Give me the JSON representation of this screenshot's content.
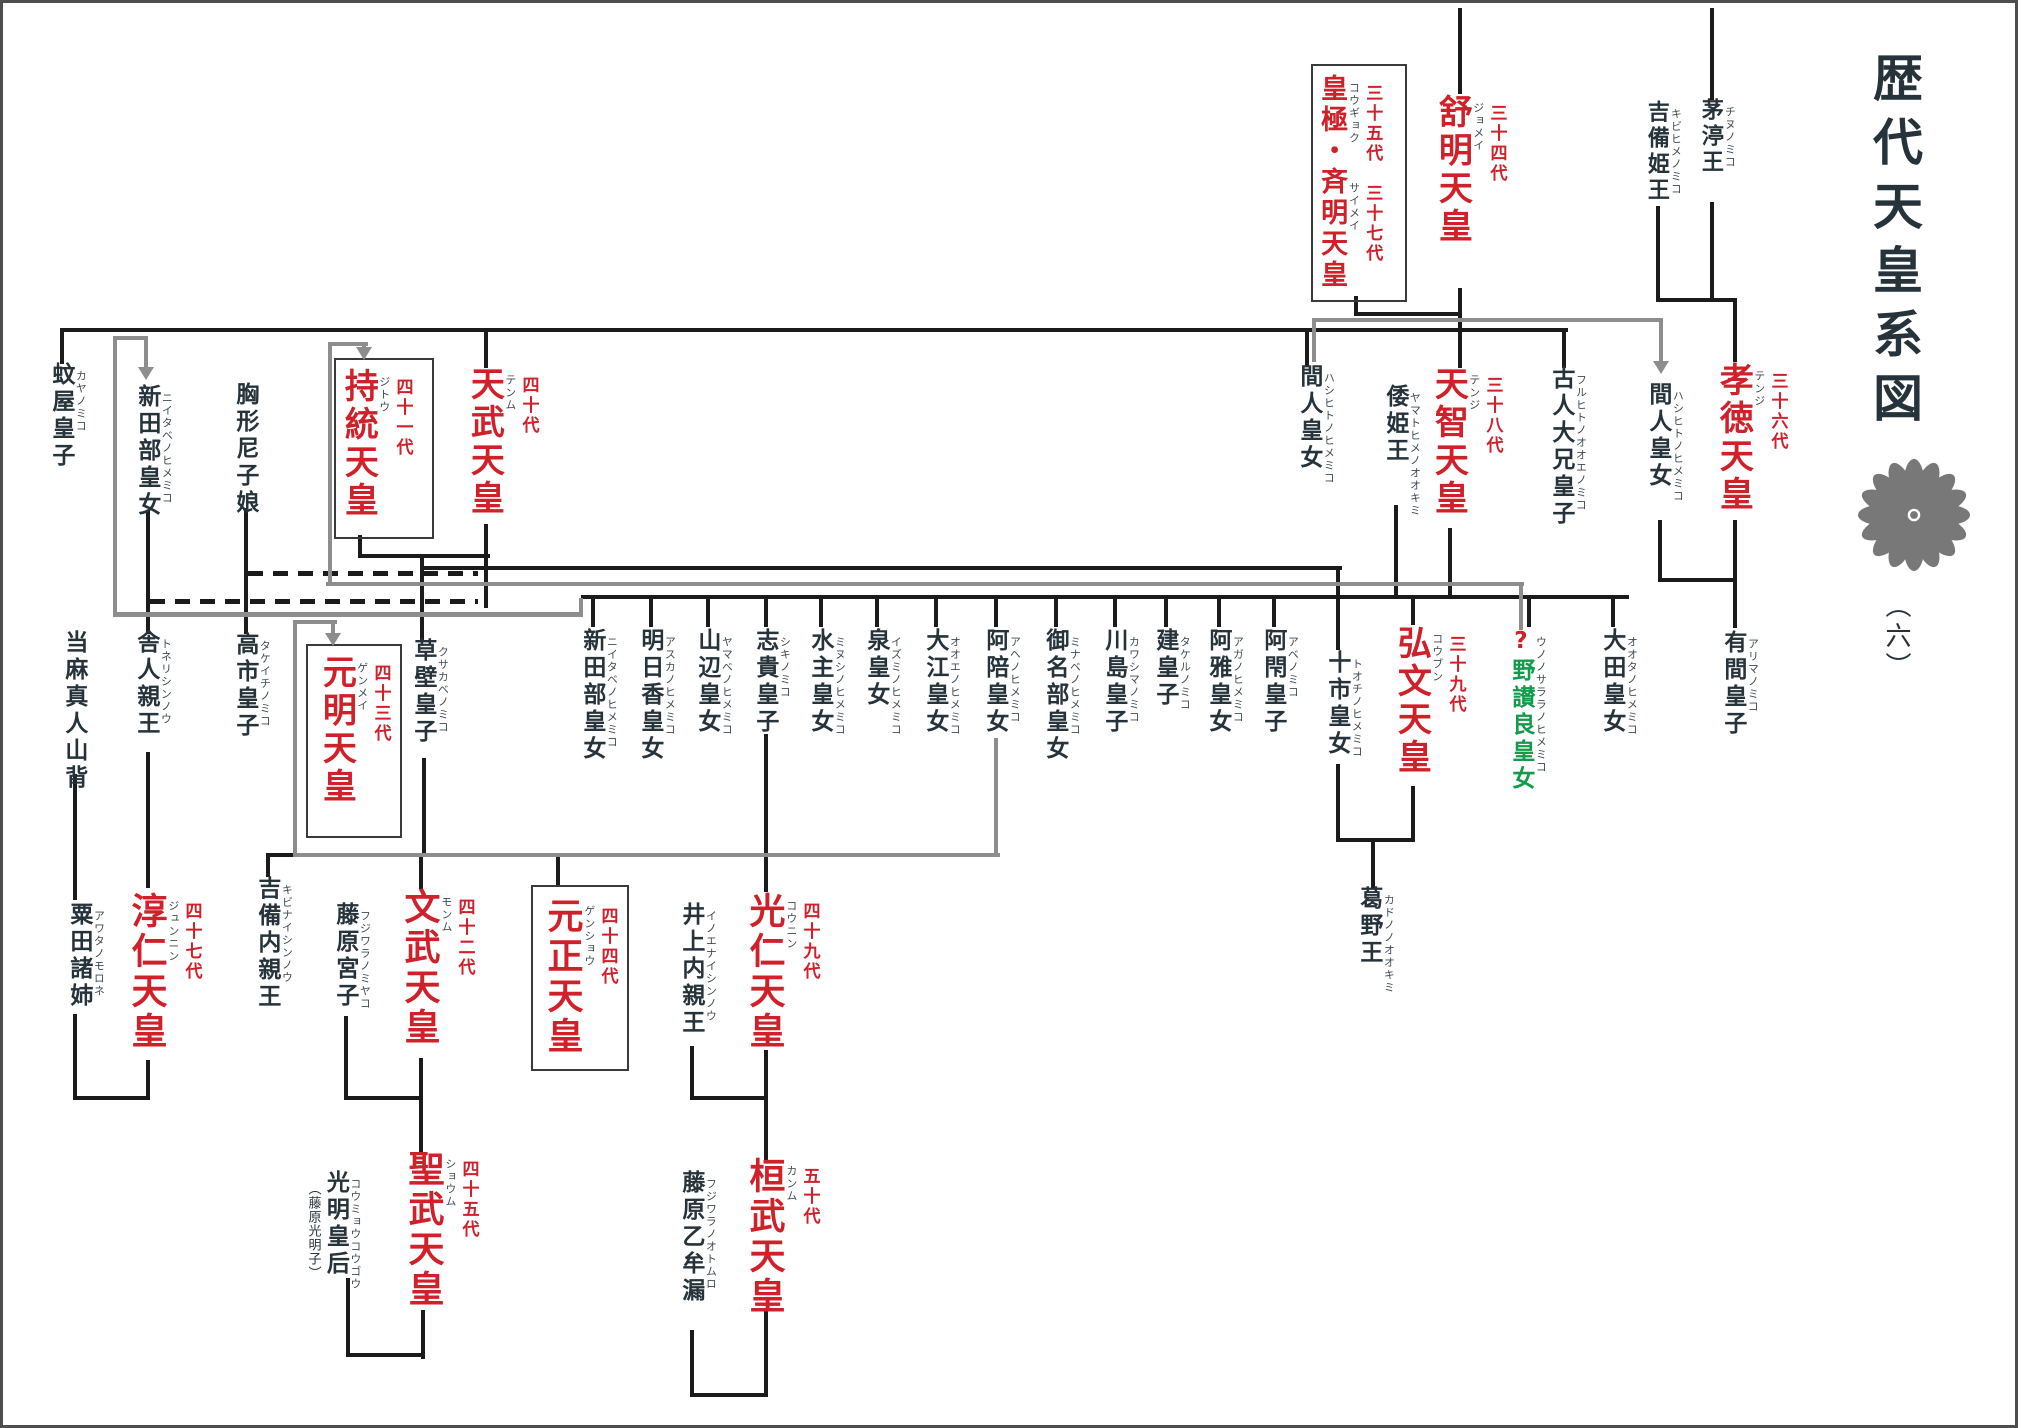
{
  "title": {
    "text": "歴代天皇系図",
    "part": "（六）"
  },
  "colors": {
    "emperor_red": "#d0202a",
    "person_black": "#26333b",
    "reading_gray": "#3c4a52",
    "special_green": "#139a4a",
    "line_black": "#1b1b1b",
    "line_gray": "#8d8d8d",
    "seal_gray": "#787878",
    "background": "#ffffff"
  },
  "nodes": [
    {
      "id": "chinu",
      "name": "茅渟王",
      "reading": "チヌノミコ",
      "x": 1698,
      "y": 98,
      "s": 22
    },
    {
      "id": "kibihime",
      "name": "吉備姫王",
      "reading": "キビヒメノミコ",
      "x": 1644,
      "y": 100,
      "s": 22
    },
    {
      "id": "kotoku",
      "name": "孝徳天皇",
      "reading": "テンジ",
      "gen": "三十六代",
      "x": 1715,
      "y": 362,
      "s": 34,
      "c": "red"
    },
    {
      "id": "hashihito-r",
      "name": "間人皇女",
      "reading": "ハシヒトノヒメミコ",
      "x": 1645,
      "y": 382,
      "s": 23
    },
    {
      "id": "arima",
      "name": "有間皇子",
      "reading": "アリマノミコ",
      "x": 1720,
      "y": 630,
      "s": 23
    },
    {
      "id": "jomei",
      "name": "舒明天皇",
      "reading": "ジョメイ",
      "gen": "三十四代",
      "x": 1434,
      "y": 94,
      "s": 34,
      "c": "red"
    },
    {
      "id": "kogyoku-saimei",
      "name": "皇極・斉明天皇",
      "reading": "コウギョク　　　サイメイ",
      "gen": "三十五代　三十七代",
      "x": 1317,
      "y": 74,
      "s": 27,
      "c": "red",
      "box": {
        "x": 1311,
        "y": 64,
        "w": 92,
        "h": 234
      }
    },
    {
      "id": "furuhito",
      "name": "古人大兄皇子",
      "reading": "フルヒトノオオエノミコ",
      "x": 1548,
      "y": 366,
      "s": 23
    },
    {
      "id": "tenji",
      "name": "天智天皇",
      "reading": "テンジ",
      "gen": "三十八代",
      "x": 1430,
      "y": 366,
      "s": 34,
      "c": "red"
    },
    {
      "id": "yamatohime",
      "name": "倭姫王",
      "reading": "ヤマトヒメノオオキミ",
      "x": 1382,
      "y": 384,
      "s": 23
    },
    {
      "id": "hashihito-l",
      "name": "間人皇女",
      "reading": "ハシヒトノヒメミコ",
      "x": 1296,
      "y": 364,
      "s": 23
    },
    {
      "id": "kaya",
      "name": "蚊屋皇子",
      "reading": "カヤノミコ",
      "x": 48,
      "y": 362,
      "s": 23
    },
    {
      "id": "niitabe-1",
      "name": "新田部皇女",
      "reading": "ニイタベノヒメミコ",
      "x": 134,
      "y": 384,
      "s": 23
    },
    {
      "id": "munakata",
      "name": "胸形尼子娘",
      "x": 232,
      "y": 382,
      "s": 23
    },
    {
      "id": "jito",
      "name": "持統天皇",
      "reading": "ジトウ",
      "gen": "四十一代",
      "x": 340,
      "y": 368,
      "s": 34,
      "c": "red",
      "box": {
        "x": 334,
        "y": 358,
        "w": 96,
        "h": 177
      }
    },
    {
      "id": "temmu",
      "name": "天武天皇",
      "reading": "テンム",
      "gen": "四十代",
      "x": 466,
      "y": 366,
      "s": 34,
      "c": "red"
    },
    {
      "id": "niitabe-2",
      "name": "新田部皇女",
      "reading": "ニイタベノヒメミコ",
      "x": 579,
      "y": 628,
      "s": 23
    },
    {
      "id": "asuka",
      "name": "明日香皇女",
      "reading": "アスカノヒメミコ",
      "x": 637,
      "y": 628,
      "s": 23
    },
    {
      "id": "yamabe",
      "name": "山辺皇女",
      "reading": "ヤマベノヒメミコ",
      "x": 694,
      "y": 628,
      "s": 23
    },
    {
      "id": "shiki",
      "name": "志貴皇子",
      "reading": "シキノミコ",
      "x": 752,
      "y": 628,
      "s": 23
    },
    {
      "id": "minushi",
      "name": "水主皇女",
      "reading": "ミヌシノヒメミコ",
      "x": 807,
      "y": 628,
      "s": 23
    },
    {
      "id": "izumi",
      "name": "泉皇女",
      "reading": "イズミノヒメミコ",
      "x": 863,
      "y": 628,
      "s": 23
    },
    {
      "id": "ooe",
      "name": "大江皇女",
      "reading": "オオエノヒメミコ",
      "x": 922,
      "y": 628,
      "s": 23
    },
    {
      "id": "ahe",
      "name": "阿陪皇女",
      "reading": "アヘノヒメミコ",
      "x": 982,
      "y": 628,
      "s": 23
    },
    {
      "id": "minabe",
      "name": "御名部皇女",
      "reading": "ミナベノヒメミコ",
      "x": 1042,
      "y": 628,
      "s": 23
    },
    {
      "id": "kawashima",
      "name": "川島皇子",
      "reading": "カワシマノミコ",
      "x": 1101,
      "y": 628,
      "s": 23
    },
    {
      "id": "takeru",
      "name": "建皇子",
      "reading": "タケルノミコ",
      "x": 1152,
      "y": 628,
      "s": 23
    },
    {
      "id": "aga",
      "name": "阿雅皇女",
      "reading": "アガノヒメミコ",
      "x": 1205,
      "y": 628,
      "s": 23
    },
    {
      "id": "abe",
      "name": "阿閇皇子",
      "reading": "アベノミコ",
      "x": 1260,
      "y": 628,
      "s": 23
    },
    {
      "id": "tochi",
      "name": "十市皇女",
      "reading": "トオチノヒメミコ",
      "x": 1324,
      "y": 650,
      "s": 23
    },
    {
      "id": "kobun",
      "name": "弘文天皇",
      "reading": "コウブン",
      "gen": "三十九代",
      "x": 1393,
      "y": 625,
      "s": 34,
      "c": "red"
    },
    {
      "id": "uno-no-sarara",
      "parts": [
        {
          "t": "?",
          "c": "#d0202a"
        },
        {
          "t": "野讃良皇女",
          "c": "#139a4a"
        }
      ],
      "reading": "ウノノサララノヒメミコ",
      "x": 1508,
      "y": 628,
      "s": 23
    },
    {
      "id": "oota",
      "name": "大田皇女",
      "reading": "オオタノヒメミコ",
      "x": 1599,
      "y": 628,
      "s": 23
    },
    {
      "id": "taima",
      "name": "当麻真人山背",
      "x": 61,
      "y": 630,
      "s": 23
    },
    {
      "id": "toneri",
      "name": "舎人親王",
      "reading": "トネリシンノウ",
      "x": 133,
      "y": 630,
      "s": 23
    },
    {
      "id": "takechi",
      "name": "高市皇子",
      "reading": "タケイチノミコ",
      "x": 232,
      "y": 632,
      "s": 23
    },
    {
      "id": "gemmei",
      "name": "元明天皇",
      "reading": "ゲンメイ",
      "gen": "四十三代",
      "x": 318,
      "y": 654,
      "s": 34,
      "c": "red",
      "box": {
        "x": 306,
        "y": 644,
        "w": 92,
        "h": 190
      }
    },
    {
      "id": "kusakabe",
      "name": "草壁皇子",
      "reading": "クサカベノミコ",
      "x": 410,
      "y": 638,
      "s": 23
    },
    {
      "id": "kadono",
      "name": "葛野王",
      "reading": "カドノノオオキミ",
      "x": 1356,
      "y": 886,
      "s": 23
    },
    {
      "id": "awata",
      "name": "粟田諸姉",
      "reading": "アワタノモロネ",
      "x": 66,
      "y": 902,
      "s": 23
    },
    {
      "id": "junnin",
      "name": "淳仁天皇",
      "reading": "ジュンニン",
      "gen": "四十七代",
      "x": 127,
      "y": 892,
      "s": 36,
      "c": "red"
    },
    {
      "id": "kibi-naishinno",
      "name": "吉備内親王",
      "reading": "キビナイシンノウ",
      "x": 254,
      "y": 876,
      "s": 23
    },
    {
      "id": "fujiwara-miyako",
      "name": "藤原宮子",
      "reading": "フジワラノミヤコ",
      "x": 332,
      "y": 902,
      "s": 23
    },
    {
      "id": "mommu",
      "name": "文武天皇",
      "reading": "モンム",
      "gen": "四十二代",
      "x": 400,
      "y": 888,
      "s": 36,
      "c": "red"
    },
    {
      "id": "gensho",
      "name": "元正天皇",
      "reading": "ゲンショウ",
      "gen": "四十四代",
      "x": 543,
      "y": 897,
      "s": 36,
      "c": "red",
      "box": {
        "x": 531,
        "y": 885,
        "w": 94,
        "h": 182
      }
    },
    {
      "id": "inoe",
      "name": "井上内親王",
      "reading": "イノエナイシンノウ",
      "x": 678,
      "y": 902,
      "s": 23
    },
    {
      "id": "konin",
      "name": "光仁天皇",
      "reading": "コウニン",
      "gen": "四十九代",
      "x": 745,
      "y": 892,
      "s": 36,
      "c": "red"
    },
    {
      "id": "shomu",
      "name": "聖武天皇",
      "reading": "ショウム",
      "gen": "四十五代",
      "x": 404,
      "y": 1150,
      "s": 36,
      "c": "red"
    },
    {
      "id": "komyo",
      "note": "（藤原光明子）",
      "name": "光明皇后",
      "reading": "コウミョウコウゴウ",
      "x": 306,
      "y": 1170,
      "s": 23
    },
    {
      "id": "kammu",
      "name": "桓武天皇",
      "reading": "カンム",
      "gen": "五十代",
      "x": 745,
      "y": 1157,
      "s": 36,
      "c": "red"
    },
    {
      "id": "fujiwara-otomuro",
      "name": "藤原乙牟漏",
      "reading": "フジワラノオトムロ",
      "x": 678,
      "y": 1170,
      "s": 23
    }
  ],
  "lines": [
    {
      "x": 1458,
      "y": 8,
      "w": 4,
      "h": 86,
      "c": "b"
    },
    {
      "x": 1710,
      "y": 8,
      "w": 4,
      "h": 92,
      "c": "b"
    },
    {
      "x": 1354,
      "y": 296,
      "w": 4,
      "h": 20,
      "c": "b"
    },
    {
      "x": 1354,
      "y": 312,
      "w": 108,
      "h": 4,
      "c": "b"
    },
    {
      "x": 1458,
      "y": 288,
      "w": 4,
      "h": 44,
      "c": "b"
    },
    {
      "x": 60,
      "y": 328,
      "w": 1508,
      "h": 4,
      "c": "b"
    },
    {
      "x": 60,
      "y": 330,
      "w": 4,
      "h": 34,
      "c": "b"
    },
    {
      "x": 484,
      "y": 330,
      "w": 4,
      "h": 38,
      "c": "b"
    },
    {
      "x": 1305,
      "y": 330,
      "w": 4,
      "h": 36,
      "c": "b"
    },
    {
      "x": 1458,
      "y": 330,
      "w": 4,
      "h": 38,
      "c": "b"
    },
    {
      "x": 1562,
      "y": 330,
      "w": 4,
      "h": 38,
      "c": "b"
    },
    {
      "x": 1656,
      "y": 206,
      "w": 4,
      "h": 96,
      "c": "b"
    },
    {
      "x": 1710,
      "y": 202,
      "w": 4,
      "h": 100,
      "c": "b"
    },
    {
      "x": 1656,
      "y": 298,
      "w": 81,
      "h": 4,
      "c": "b"
    },
    {
      "x": 1733,
      "y": 300,
      "w": 4,
      "h": 62,
      "c": "b"
    },
    {
      "x": 1658,
      "y": 520,
      "w": 4,
      "h": 62,
      "c": "b"
    },
    {
      "x": 1658,
      "y": 578,
      "w": 79,
      "h": 4,
      "c": "b"
    },
    {
      "x": 1733,
      "y": 520,
      "w": 4,
      "h": 62,
      "c": "b"
    },
    {
      "x": 1733,
      "y": 578,
      "w": 4,
      "h": 50,
      "c": "b"
    },
    {
      "x": 358,
      "y": 535,
      "w": 4,
      "h": 23,
      "c": "b"
    },
    {
      "x": 484,
      "y": 524,
      "w": 4,
      "h": 84,
      "c": "b"
    },
    {
      "x": 358,
      "y": 554,
      "w": 132,
      "h": 4,
      "c": "b"
    },
    {
      "x": 420,
      "y": 554,
      "w": 4,
      "h": 86,
      "c": "b"
    },
    {
      "x": 420,
      "y": 566,
      "w": 922,
      "h": 4,
      "c": "b"
    },
    {
      "x": 581,
      "y": 595,
      "w": 1048,
      "h": 4,
      "c": "b"
    },
    {
      "x": 146,
      "y": 510,
      "w": 4,
      "h": 124,
      "c": "b"
    },
    {
      "x": 244,
      "y": 508,
      "w": 4,
      "h": 126,
      "c": "b"
    },
    {
      "x": 1394,
      "y": 505,
      "w": 4,
      "h": 92,
      "c": "b"
    },
    {
      "x": 1448,
      "y": 528,
      "w": 4,
      "h": 69,
      "c": "b"
    },
    {
      "x": 248,
      "y": 571,
      "w": 230,
      "h": 5,
      "c": "b",
      "dashed": true
    },
    {
      "x": 150,
      "y": 599,
      "w": 328,
      "h": 5,
      "c": "b",
      "dashed": true
    },
    {
      "x": 591,
      "y": 597,
      "w": 4,
      "h": 30,
      "c": "b"
    },
    {
      "x": 649,
      "y": 597,
      "w": 4,
      "h": 30,
      "c": "b"
    },
    {
      "x": 706,
      "y": 597,
      "w": 4,
      "h": 30,
      "c": "b"
    },
    {
      "x": 764,
      "y": 597,
      "w": 4,
      "h": 30,
      "c": "b"
    },
    {
      "x": 819,
      "y": 597,
      "w": 4,
      "h": 30,
      "c": "b"
    },
    {
      "x": 875,
      "y": 597,
      "w": 4,
      "h": 30,
      "c": "b"
    },
    {
      "x": 934,
      "y": 597,
      "w": 4,
      "h": 30,
      "c": "b"
    },
    {
      "x": 994,
      "y": 597,
      "w": 4,
      "h": 30,
      "c": "b"
    },
    {
      "x": 1054,
      "y": 597,
      "w": 4,
      "h": 30,
      "c": "b"
    },
    {
      "x": 1113,
      "y": 597,
      "w": 4,
      "h": 30,
      "c": "b"
    },
    {
      "x": 1164,
      "y": 597,
      "w": 4,
      "h": 30,
      "c": "b"
    },
    {
      "x": 1217,
      "y": 597,
      "w": 4,
      "h": 30,
      "c": "b"
    },
    {
      "x": 1272,
      "y": 597,
      "w": 4,
      "h": 30,
      "c": "b"
    },
    {
      "x": 1611,
      "y": 597,
      "w": 4,
      "h": 30,
      "c": "b"
    },
    {
      "x": 1411,
      "y": 597,
      "w": 4,
      "h": 28,
      "c": "b"
    },
    {
      "x": 1527,
      "y": 597,
      "w": 4,
      "h": 30,
      "c": "b"
    },
    {
      "x": 1336,
      "y": 566,
      "w": 4,
      "h": 84,
      "c": "b"
    },
    {
      "x": 764,
      "y": 734,
      "w": 4,
      "h": 158,
      "c": "b"
    },
    {
      "x": 422,
      "y": 758,
      "w": 4,
      "h": 97,
      "c": "b"
    },
    {
      "x": 266,
      "y": 853,
      "w": 298,
      "h": 4,
      "c": "b"
    },
    {
      "x": 266,
      "y": 853,
      "w": 4,
      "h": 24,
      "c": "b"
    },
    {
      "x": 419,
      "y": 853,
      "w": 4,
      "h": 36,
      "c": "b"
    },
    {
      "x": 556,
      "y": 853,
      "w": 4,
      "h": 32,
      "c": "b"
    },
    {
      "x": 73,
      "y": 774,
      "w": 4,
      "h": 126,
      "c": "b"
    },
    {
      "x": 146,
      "y": 752,
      "w": 4,
      "h": 136,
      "c": "b"
    },
    {
      "x": 73,
      "y": 1014,
      "w": 4,
      "h": 86,
      "c": "b"
    },
    {
      "x": 73,
      "y": 1096,
      "w": 77,
      "h": 4,
      "c": "b"
    },
    {
      "x": 146,
      "y": 1060,
      "w": 4,
      "h": 40,
      "c": "b"
    },
    {
      "x": 344,
      "y": 1016,
      "w": 4,
      "h": 84,
      "c": "b"
    },
    {
      "x": 344,
      "y": 1096,
      "w": 79,
      "h": 4,
      "c": "b"
    },
    {
      "x": 419,
      "y": 1058,
      "w": 4,
      "h": 94,
      "c": "b"
    },
    {
      "x": 421,
      "y": 1310,
      "w": 4,
      "h": 49,
      "c": "b"
    },
    {
      "x": 346,
      "y": 1353,
      "w": 79,
      "h": 4,
      "c": "b"
    },
    {
      "x": 346,
      "y": 1278,
      "w": 4,
      "h": 79,
      "c": "b"
    },
    {
      "x": 690,
      "y": 1046,
      "w": 4,
      "h": 54,
      "c": "b"
    },
    {
      "x": 690,
      "y": 1096,
      "w": 78,
      "h": 4,
      "c": "b"
    },
    {
      "x": 764,
      "y": 1050,
      "w": 4,
      "h": 110,
      "c": "b"
    },
    {
      "x": 690,
      "y": 1330,
      "w": 4,
      "h": 67,
      "c": "b"
    },
    {
      "x": 690,
      "y": 1393,
      "w": 78,
      "h": 4,
      "c": "b"
    },
    {
      "x": 764,
      "y": 1310,
      "w": 4,
      "h": 87,
      "c": "b"
    },
    {
      "x": 1336,
      "y": 764,
      "w": 4,
      "h": 78,
      "c": "b"
    },
    {
      "x": 1411,
      "y": 786,
      "w": 4,
      "h": 56,
      "c": "b"
    },
    {
      "x": 1336,
      "y": 838,
      "w": 79,
      "h": 4,
      "c": "b"
    },
    {
      "x": 1371,
      "y": 838,
      "w": 4,
      "h": 50,
      "c": "b"
    },
    {
      "x": 1312,
      "y": 318,
      "w": 4,
      "h": 44,
      "c": "g"
    },
    {
      "x": 1312,
      "y": 318,
      "w": 351,
      "h": 4,
      "c": "g"
    },
    {
      "x": 1659,
      "y": 318,
      "w": 4,
      "h": 44,
      "c": "g"
    },
    {
      "x": 328,
      "y": 342,
      "w": 4,
      "h": 244,
      "c": "g"
    },
    {
      "x": 328,
      "y": 342,
      "w": 40,
      "h": 4,
      "c": "g"
    },
    {
      "x": 362,
      "y": 342,
      "w": 4,
      "h": 6,
      "c": "g"
    },
    {
      "x": 326,
      "y": 582,
      "w": 1198,
      "h": 4,
      "c": "g"
    },
    {
      "x": 1519,
      "y": 584,
      "w": 4,
      "h": 46,
      "c": "g"
    },
    {
      "x": 994,
      "y": 738,
      "w": 4,
      "h": 119,
      "c": "g"
    },
    {
      "x": 293,
      "y": 853,
      "w": 707,
      "h": 4,
      "c": "g"
    },
    {
      "x": 293,
      "y": 620,
      "w": 4,
      "h": 237,
      "c": "g"
    },
    {
      "x": 293,
      "y": 620,
      "w": 44,
      "h": 4,
      "c": "g"
    },
    {
      "x": 331,
      "y": 620,
      "w": 4,
      "h": 14,
      "c": "g"
    },
    {
      "x": 113,
      "y": 336,
      "w": 4,
      "h": 280,
      "c": "g"
    },
    {
      "x": 113,
      "y": 336,
      "w": 35,
      "h": 4,
      "c": "g"
    },
    {
      "x": 144,
      "y": 336,
      "w": 4,
      "h": 32,
      "c": "g"
    },
    {
      "x": 113,
      "y": 612,
      "w": 470,
      "h": 5,
      "c": "g"
    },
    {
      "x": 579,
      "y": 598,
      "w": 4,
      "h": 19,
      "c": "g"
    }
  ],
  "arrows": [
    {
      "x": 1661,
      "y": 374
    },
    {
      "x": 146,
      "y": 380
    },
    {
      "x": 364,
      "y": 360
    },
    {
      "x": 333,
      "y": 646
    }
  ],
  "seal": {
    "name": "chrysanthemum-crest",
    "petals": 16
  }
}
